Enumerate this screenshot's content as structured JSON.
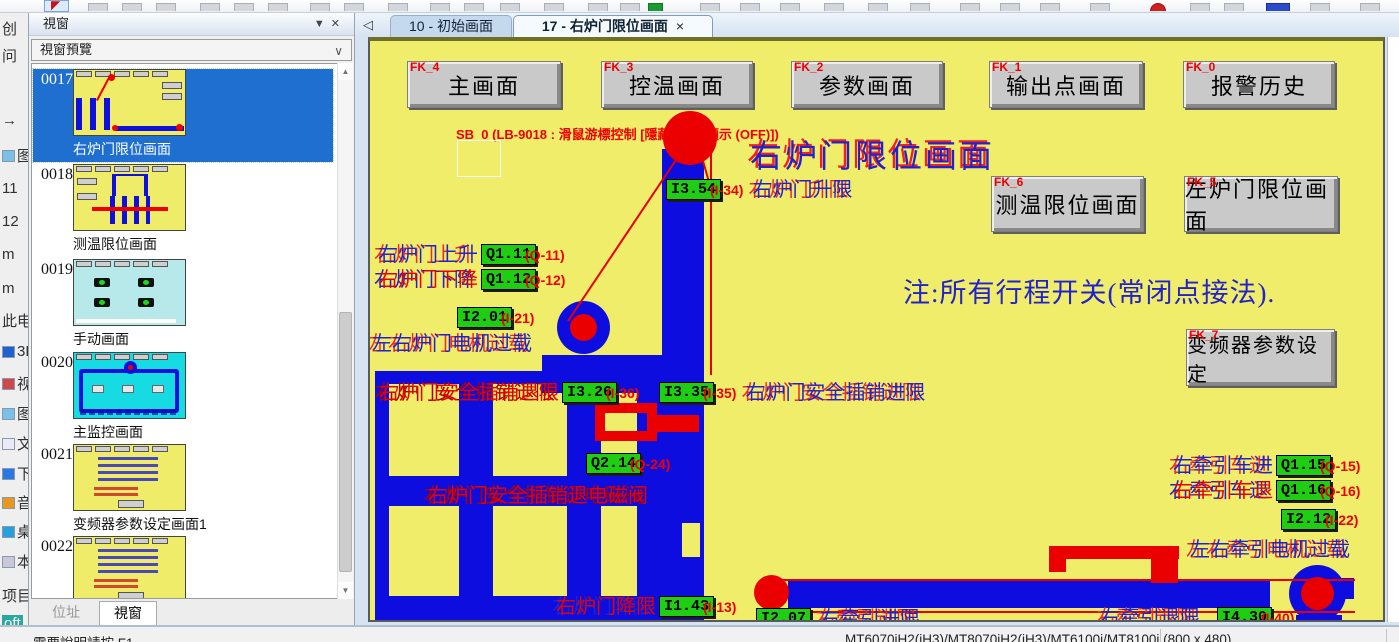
{
  "window": {
    "panel_title": "視窗",
    "panel_caret": "▼",
    "panel_close": "✕",
    "preview_label": "視窗預覽",
    "combo_chevron": "∨",
    "scroll_up": "▲",
    "scroll_down": "▼",
    "panel_tabs": {
      "address": "位址",
      "window": "視窗"
    }
  },
  "tabbar": {
    "back_arrow": "◁",
    "tabs": [
      {
        "label": "10 - 初始画面"
      },
      {
        "label": "17 - 右炉门限位画面",
        "close": "×"
      }
    ]
  },
  "sidebar_items": [
    {
      "id": "0017",
      "label": "右炉门限位画面"
    },
    {
      "id": "0018",
      "label": "测温限位画面"
    },
    {
      "id": "0019",
      "label": "手动画面"
    },
    {
      "id": "0020",
      "label": "主监控画面"
    },
    {
      "id": "0021",
      "label": "变频器参数设定画面1"
    },
    {
      "id": "0022",
      "label": ""
    }
  ],
  "canvas": {
    "nav_buttons": [
      {
        "tag": "FK_4",
        "label": "主画面"
      },
      {
        "tag": "FK_3",
        "label": "控温画面"
      },
      {
        "tag": "FK_2",
        "label": "参数画面"
      },
      {
        "tag": "FK_1",
        "label": "输出点画面"
      },
      {
        "tag": "FK_0",
        "label": "报警历史"
      },
      {
        "tag": "FK_6",
        "label": "测温限位画面"
      },
      {
        "tag": "FK_5",
        "label": "左炉门限位画面"
      },
      {
        "tag": "FK_7",
        "label": "变频器参数设定"
      }
    ],
    "sb0": "SB_0 (LB-9018 : 滑鼠游標控制 [隱藏 (ON)/顯示 (OFF)])",
    "title": "右炉门限位画面",
    "note": "注:所有行程开关(常闭点接法).",
    "colors": {
      "background": "#f0ed6b",
      "machine_blue": "#0d0de0",
      "alarm_red": "#ea0000",
      "io_green": "#1fce12"
    },
    "io_labels": [
      {
        "chip": "I3.54",
        "paren": "(I-34)",
        "cn": "右炉门升限"
      },
      {
        "cn": "右炉门上升",
        "chip": "Q1.11",
        "paren": "(Q-11)"
      },
      {
        "cn": "右炉门下降",
        "chip": "Q1.12",
        "paren": "(Q-12)"
      },
      {
        "chip": "I2.01",
        "paren": "(I-21)"
      },
      {
        "cn": "左右炉门电机过载"
      },
      {
        "cn": "右炉门安全插销退限",
        "chip": "I3.26",
        "paren": "(I-36)"
      },
      {
        "chip": "I3.35",
        "paren": "(I-35)",
        "cn": "右炉门安全插销进限"
      },
      {
        "chip": "Q2.14",
        "paren": "(Q-24)"
      },
      {
        "cn": "右炉门安全插销退电磁阀"
      },
      {
        "cn": "右炉门降限",
        "chip": "I1.43",
        "paren": "(I-13)"
      },
      {
        "chip": "I2.07",
        "cn": "右牵引进限"
      },
      {
        "cn": "右牵引车进",
        "chip": "Q1.15",
        "paren": "(Q-15)"
      },
      {
        "cn": "右牵引车退",
        "chip": "Q1.16",
        "paren": "(Q-16)"
      },
      {
        "chip": "I2.12",
        "paren": "(I-22)"
      },
      {
        "cn": "左右牵引电机过载"
      },
      {
        "cn": "右牵引退限",
        "chip": "I4.30",
        "paren": "(I-40)"
      }
    ]
  },
  "statusbar": {
    "help": "需要說明請按 F1",
    "device": "MT6070iH2(iH3)/MT8070iH2(iH3)/MT6100i/MT8100i (800 x 480)"
  },
  "desktop_icons": [
    "创",
    "问",
    "→",
    "图",
    "11",
    "12",
    "m",
    "m",
    "此电",
    "3D",
    "视",
    "图",
    "文",
    "下",
    "音",
    "桌",
    "本",
    "项目",
    "oft"
  ]
}
